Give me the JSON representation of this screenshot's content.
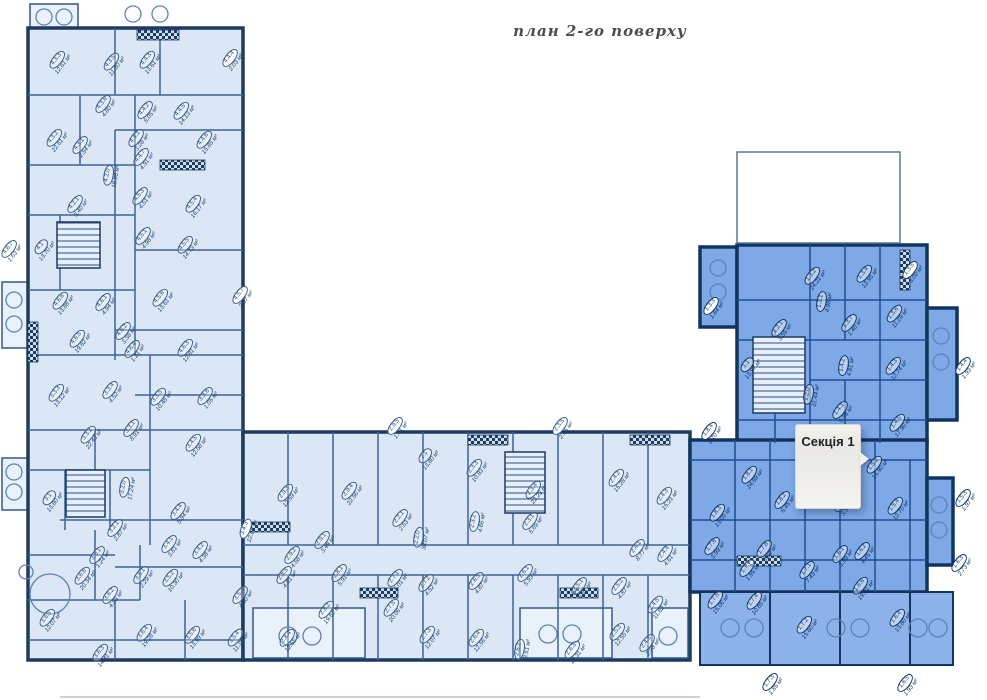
{
  "title": "план 2-го поверху",
  "section_badge": {
    "label": "Секція 1"
  },
  "colors": {
    "room_fill_light": "#dbe7f5",
    "room_fill_highlight": "#7ea8e6",
    "wall_dark": "#1d3a5f",
    "wall_highlight": "#12355f",
    "interior_line": "#3c6396",
    "label_text": "#24456e",
    "badge_bg": "#f2f1ee"
  },
  "sections": [
    {
      "name": "section-4",
      "highlight": false,
      "rooms": [
        [
          "4.3.3",
          "12.61 м²",
          60,
          62
        ],
        [
          "4.3.5",
          "11.30 м²",
          114,
          64
        ],
        [
          "4.4.3",
          "13.61 м²",
          150,
          62
        ],
        [
          "4.4.4",
          "2.03 м²",
          233,
          60,
          {
            "c": 1
          }
        ],
        [
          "4.3.6",
          "4.80 м²",
          106,
          106
        ],
        [
          "4.4.2",
          "5.05 м²",
          148,
          112
        ],
        [
          "4.4.5",
          "14.13 м²",
          184,
          113
        ],
        [
          "4.3.2",
          "22.61 м²",
          57,
          140
        ],
        [
          "4.3.1",
          "2.54 м²",
          83,
          147
        ],
        [
          "4.4.1",
          "3.28 м²",
          139,
          140
        ],
        [
          "4.4.7",
          "4.91 м²",
          144,
          159
        ],
        [
          "4.4.6",
          "15.85 м²",
          207,
          142
        ],
        [
          "4.2.0",
          "18.98 м²",
          112,
          176,
          {
            "r": -80
          }
        ],
        [
          "4.2.1",
          "3.40 м²",
          78,
          206
        ],
        [
          "4.5.3",
          "4.51 м²",
          143,
          198
        ],
        [
          "4.5.4",
          "16.17 м²",
          196,
          206
        ],
        [
          "4.1",
          "13.70 м²",
          44,
          249
        ],
        [
          "4.5.1",
          "4.98 м²",
          146,
          238
        ],
        [
          "4.5.5",
          "14.73 м²",
          188,
          247
        ],
        [
          "4.6.7",
          "1.63 м²",
          12,
          251,
          {
            "c": 1
          }
        ],
        [
          "4.6.6",
          "13.88 м²",
          63,
          303
        ],
        [
          "4.6.1",
          "4.94 м²",
          106,
          304
        ],
        [
          "4.5.6",
          "13.61 м²",
          163,
          300
        ],
        [
          "4.5.7",
          "2.87 м²",
          243,
          297,
          {
            "c": 1
          }
        ],
        [
          "4.6.5",
          "19.62 м²",
          80,
          341
        ],
        [
          "4.6.2",
          "3.38 м²",
          126,
          333
        ],
        [
          "4.6.4",
          "1.21 м²",
          135,
          351
        ],
        [
          "4.6.3",
          "12.81 м²",
          188,
          350
        ]
      ]
    },
    {
      "name": "section-3",
      "highlight": false,
      "rooms": [
        [
          "3.3.3",
          "13.12 м²",
          59,
          395
        ],
        [
          "3.3.4",
          "4.52 м²",
          113,
          392
        ],
        [
          "3.3.5",
          "10.48 м²",
          161,
          399
        ],
        [
          "3.3.6",
          "1.05 м²",
          208,
          398
        ],
        [
          "3.3.1",
          "8.91 м²",
          134,
          430
        ],
        [
          "3.3.2",
          "22.43 м²",
          91,
          437
        ],
        [
          "3.4.5",
          "12.58 м²",
          196,
          445
        ],
        [
          "3.1",
          "13.80 м²",
          52,
          500
        ],
        [
          "3.2.0",
          "17.24 м²",
          128,
          488,
          {
            "r": -80
          }
        ],
        [
          "3.2.1",
          "2.87 м²",
          118,
          530
        ],
        [
          "3.4.4",
          "5.94 м²",
          181,
          513
        ],
        [
          "3.4.3",
          "12.68 м²",
          249,
          530,
          {
            "c": 1,
            "r": -70
          }
        ],
        [
          "3.4.1",
          "3.81 м²",
          172,
          546
        ],
        [
          "3.4.2",
          "4.38 м²",
          203,
          552
        ],
        [
          "3.6.1",
          "1.24 м²",
          100,
          557
        ],
        [
          "3.6.6",
          "20.34 м²",
          85,
          578
        ],
        [
          "3.6.2",
          "4.53 м²",
          113,
          597
        ],
        [
          "3.5.1",
          "2.29 м²",
          144,
          577
        ],
        [
          "3.5.2",
          "10.30 м²",
          173,
          580
        ],
        [
          "3.5.3",
          "4.60 м²",
          243,
          597
        ],
        [
          "3.6.5",
          "12.07 м²",
          50,
          620
        ],
        [
          "3.6.4",
          "19.28 м²",
          147,
          635
        ],
        [
          "3.6.3",
          "14.41 м²",
          103,
          655
        ],
        [
          "3.5.6",
          "13.99 м²",
          195,
          637
        ],
        [
          "3.5.4",
          "11.38 м²",
          238,
          640
        ]
      ]
    },
    {
      "name": "section-2",
      "highlight": false,
      "rooms": [
        [
          "2.9.5",
          "1.41 м²",
          398,
          428,
          {
            "c": 1
          }
        ],
        [
          "2.9.3",
          "12.59 м²",
          288,
          495
        ],
        [
          "2.9.4",
          "22.56 м²",
          352,
          493
        ],
        [
          "2.1",
          "13.80 м²",
          428,
          458
        ],
        [
          "2.2.1",
          "2.53 м²",
          403,
          520
        ],
        [
          "2.2.0",
          "38.07 м²",
          422,
          538,
          {
            "r": -80
          }
        ],
        [
          "2.9.1",
          "3.48 м²",
          325,
          542
        ],
        [
          "2.9.2",
          "4.58 м²",
          295,
          557
        ],
        [
          "2.3.3",
          "10.83 м²",
          477,
          470
        ],
        [
          "2.3.5",
          "2.66 м²",
          563,
          428,
          {
            "c": 1
          }
        ],
        [
          "2.3.4",
          "22.23 м²",
          536,
          492
        ],
        [
          "2.3.2",
          "4.66 м²",
          478,
          522,
          {
            "r": -80
          }
        ],
        [
          "2.3.1",
          "5.69 м²",
          533,
          523
        ],
        [
          "2.4.2",
          "15.28 м²",
          619,
          480
        ],
        [
          "2.4.3",
          "15.21 м²",
          667,
          498
        ],
        [
          "2.4.1",
          "8.77 м²",
          640,
          550
        ],
        [
          "2.4.4",
          "4.61 м²",
          668,
          555
        ],
        [
          "2.8.5",
          "4.81 м²",
          287,
          577
        ],
        [
          "2.8.1",
          "5.91 м²",
          342,
          575
        ],
        [
          "2.8.2",
          "19.62 м²",
          329,
          612
        ],
        [
          "2.7.1",
          "6.01 м²",
          398,
          580
        ],
        [
          "2.7.2",
          "4.52 м²",
          429,
          585
        ],
        [
          "2.7.5",
          "20.06 м²",
          394,
          610
        ],
        [
          "2.6.5",
          "4.87 м²",
          479,
          583
        ],
        [
          "2.6.1",
          "5.93 м²",
          528,
          575
        ],
        [
          "2.5.1",
          "6.81 м²",
          582,
          588
        ],
        [
          "2.5.2",
          "4.87 м²",
          622,
          588
        ],
        [
          "2.4.5",
          "11.62 м²",
          658,
          607
        ],
        [
          "2.4.6",
          "2.93 м²",
          650,
          645
        ],
        [
          "2.8.4",
          "12.55 м²",
          290,
          640
        ],
        [
          "2.7.3",
          "12.07 м²",
          430,
          637
        ],
        [
          "2.6.4",
          "12.56 м²",
          479,
          640
        ],
        [
          "2.6.2",
          "19.61 м²",
          523,
          650,
          {
            "r": -80
          }
        ],
        [
          "2.6.3",
          "18.31 м²",
          575,
          652
        ],
        [
          "2.5.3",
          "12.55 м²",
          620,
          634
        ]
      ]
    },
    {
      "name": "section-1",
      "highlight": true,
      "rooms": [
        [
          "1.3.3",
          "1.84 м²",
          714,
          308,
          {
            "c": 1
          }
        ],
        [
          "1.3.2",
          "24.21 м²",
          815,
          278
        ],
        [
          "1.3.1",
          "4.96 м²",
          825,
          302,
          {
            "r": -80
          }
        ],
        [
          "1.3.4",
          "12.95 м²",
          867,
          276
        ],
        [
          "1.3.5",
          "3.00 м²",
          913,
          272,
          {
            "c": 1
          }
        ],
        [
          "1.2.1",
          "3.55 м²",
          782,
          330
        ],
        [
          "1.3.7",
          "1.40 м²",
          852,
          325
        ],
        [
          "1.3.6",
          "11.29 м²",
          897,
          316
        ],
        [
          "1.1",
          "13.97 м²",
          750,
          367
        ],
        [
          "1.2.0",
          "31.44 м²",
          812,
          395,
          {
            "r": -80
          }
        ],
        [
          "1.4.2",
          "4.81 м²",
          847,
          366,
          {
            "r": -80
          }
        ],
        [
          "1.4.3",
          "12.74 м²",
          896,
          368
        ],
        [
          "1.4.4",
          "1.93 м²",
          966,
          368,
          {
            "c": 1
          }
        ],
        [
          "1.4.1",
          "5.95 м²",
          843,
          412
        ],
        [
          "1.4.5",
          "17.90 м²",
          900,
          425
        ],
        [
          "1.8.4",
          "2.70 м²",
          712,
          433,
          {
            "c": 1
          }
        ],
        [
          "1.8.1",
          "24.69 м²",
          752,
          477
        ],
        [
          "1.8.2",
          "6.45 м²",
          785,
          502
        ],
        [
          "1.8.3",
          "13.05 м²",
          720,
          515
        ],
        [
          "1.5.1",
          "3.56 м²",
          845,
          505
        ],
        [
          "1.5.2",
          "16.90 м²",
          877,
          467
        ],
        [
          "1.5.4",
          "12.70 м²",
          898,
          508
        ],
        [
          "1.5.3",
          "1.97 м²",
          966,
          500,
          {
            "c": 1
          }
        ],
        [
          "1.7.6",
          "3.99 м²",
          715,
          548
        ],
        [
          "1.7.7",
          "1.95 м²",
          750,
          570
        ],
        [
          "1.7.8",
          "6.32 м²",
          767,
          551
        ],
        [
          "1.6.1",
          "3.99 м²",
          843,
          556
        ],
        [
          "1.6.2",
          "4.45 м²",
          865,
          553
        ],
        [
          "1.7.1",
          "7.43 м²",
          810,
          572
        ],
        [
          "1.6.6",
          "19.21 м²",
          863,
          588
        ],
        [
          "1.7.5",
          "15.06 м²",
          718,
          602
        ],
        [
          "1.7.4",
          "10.85 м²",
          757,
          603
        ],
        [
          "1.7.2",
          "15.60 м²",
          807,
          627
        ],
        [
          "1.6.4",
          "13.80 м²",
          900,
          620
        ],
        [
          "1.6.3",
          "2.73 м²",
          962,
          565,
          {
            "c": 1
          }
        ],
        [
          "1.7.3",
          "1.85 м²",
          773,
          684,
          {
            "c": 1
          }
        ],
        [
          "1.6.5",
          "1.93 м²",
          908,
          685,
          {
            "c": 1
          }
        ]
      ]
    }
  ]
}
